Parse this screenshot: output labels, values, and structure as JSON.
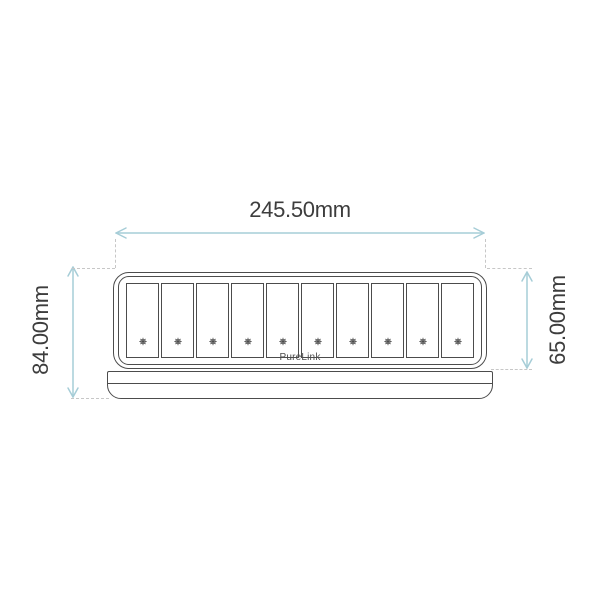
{
  "diagram": {
    "dimensions": {
      "width_label": "245.50mm",
      "total_height_label": "84.00mm",
      "body_height_label": "65.00mm"
    },
    "device": {
      "brand_label": "PureLink",
      "slot_count": 10,
      "slot_icon": "screw-head-icon"
    },
    "colors": {
      "outline": "#4c4c4c",
      "arrow": "#a6cdd7",
      "extension": "#c7c7c7",
      "label_text": "#3d3d3d",
      "background": "#ffffff"
    }
  }
}
